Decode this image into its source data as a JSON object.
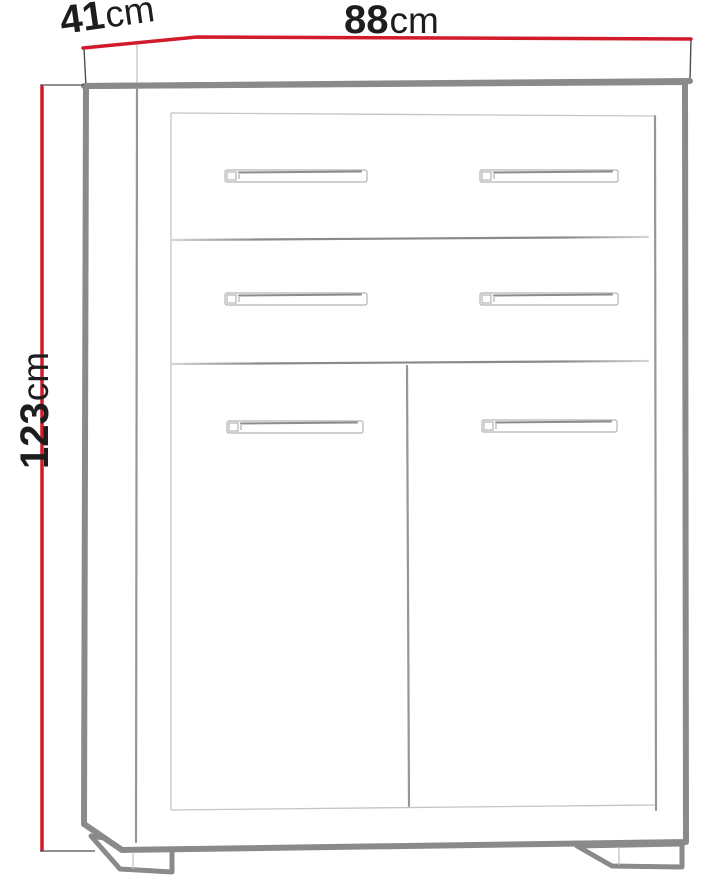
{
  "diagram": {
    "type": "furniture-dimension-diagram",
    "subject": "cabinet with 2 drawers and 2 doors on feet",
    "colors": {
      "dimension_line": "#d11a2a",
      "outline_thick": "#8a8a8a",
      "outline_medium": "#969696",
      "outline_light": "#c4c4c4",
      "label_text": "#1d1d1d"
    },
    "dimensions": {
      "depth": {
        "value": "41",
        "unit": "cm"
      },
      "width": {
        "value": "88",
        "unit": "cm"
      },
      "height": {
        "value": "123",
        "unit": "cm"
      }
    }
  }
}
